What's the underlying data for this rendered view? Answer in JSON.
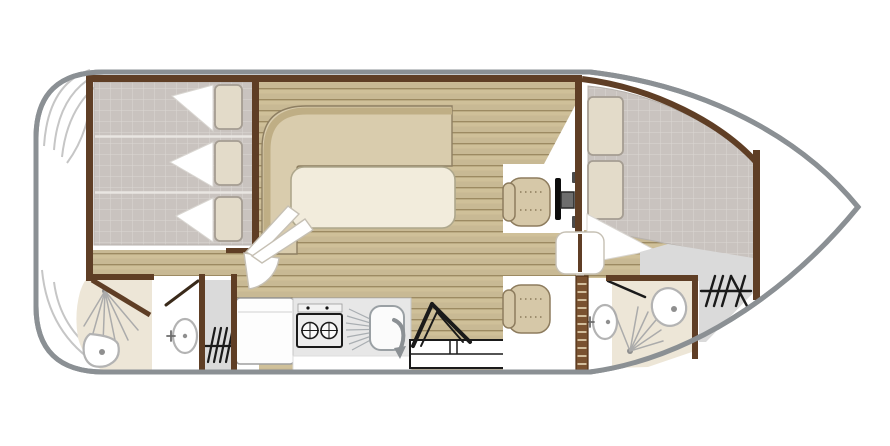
{
  "diagram": {
    "type": "boat-floor-plan",
    "orientation": "bow-right"
  },
  "colors": {
    "hull": "#8b9094",
    "wall": "#5f3e25",
    "wood": "#cfc099",
    "wood_line": "#9c8a62",
    "mattress": "#c9c3bf",
    "mattress_grid": "#dbd7d3",
    "pillow": "#e3dbc9",
    "pillow_edge": "#a59d92",
    "sofa": "#d9ccad",
    "sofa_dark": "#bfae85",
    "sofa_edge": "#8e7f62",
    "table": "#f2ecdc",
    "table_edge": "#aea78c",
    "seat": "#d6c8a8",
    "seat_edge": "#8d7c5e",
    "seat_stitch": "#9e8e6e",
    "bath_floor": "#ede6d7",
    "deck_gray": "#dadada",
    "counter": "#e7e7e7",
    "fixture": "#b3b3b3",
    "fixture_dot": "#8f8f8f",
    "spray": "#ababab",
    "canopy": "#c6c6c6",
    "ladder": "#7a5230",
    "ink": "#1a1a1a"
  },
  "legend": {
    "hull": "hull outline",
    "stern_deck": "stern deck with folded canopy",
    "aft_cabin": "aft cabin double bed",
    "aft_bathroom": "aft bathroom with shower, toilet and washbasin",
    "galley": "galley with fridge, hob and sink",
    "salon": "salon with L-sofa and table",
    "companionway": "companionway steps and bench",
    "helm": "helm station with pilot seat and steering wheel",
    "passenger_seat": "passenger seat",
    "cabin_door": "cabin door",
    "ladder": "access ladder",
    "bow_cabin": "bow cabin double bed",
    "bow_bathroom": "bow bathroom with shower, toilet and washbasin",
    "bow_deck": "bow deck area with steps",
    "steps_icon": "steps symbol",
    "shower": "shower spray symbol",
    "toilet": "toilet symbol",
    "washbasin": "washbasin symbol"
  }
}
